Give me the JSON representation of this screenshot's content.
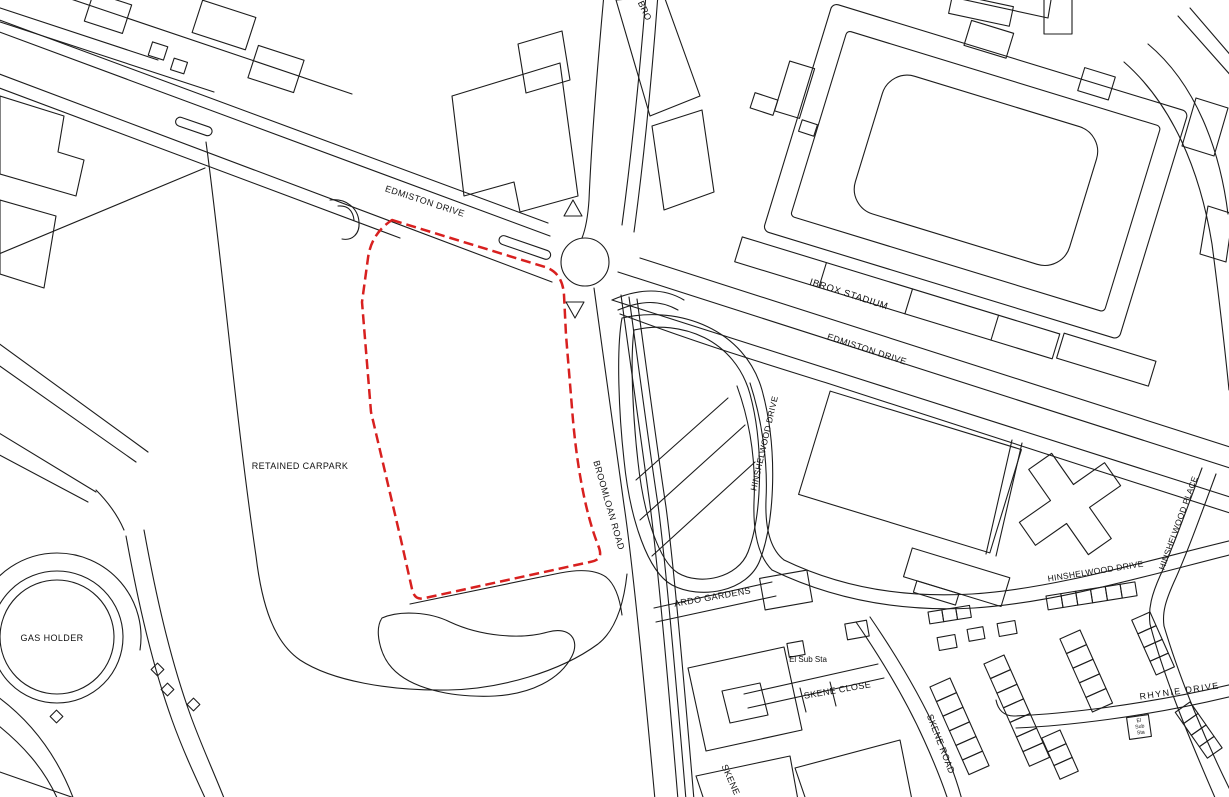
{
  "map": {
    "colors": {
      "background": "#ffffff",
      "line": "#1c1c1c",
      "boundary": "#d8201f",
      "label": "#111111"
    },
    "labels": {
      "edmiston_drive_west": "EDMISTON DRIVE",
      "edmiston_drive_east": "EDMISTON DRIVE",
      "ibrox_stadium": "IBROX STADIUM",
      "retained_carpark": "RETAINED CARPARK",
      "gas_holder": "GAS HOLDER",
      "broomloan_road": "BROOMLOAN ROAD",
      "broomloan_road_partial": "BRO",
      "hinshelwood_drive_mid": "HINSHELWOOD DRIVE",
      "hinshelwood_drive_east": "HINSHELWOOD DRIVE",
      "hinshelwood_place": "HINSHELWOOD PLACE",
      "ardo_gardens": "ARDO GARDENS",
      "el_sub_sta": "El Sub Sta",
      "el_sub_sta_small_lines": [
        "El",
        "Sub",
        "Sta"
      ],
      "skene_close": "SKENE CLOSE",
      "skene_road": "SKENE ROAD",
      "skene_road_partial": "SKENE",
      "rhynie_drive": "RHYNIE DRIVE"
    }
  }
}
